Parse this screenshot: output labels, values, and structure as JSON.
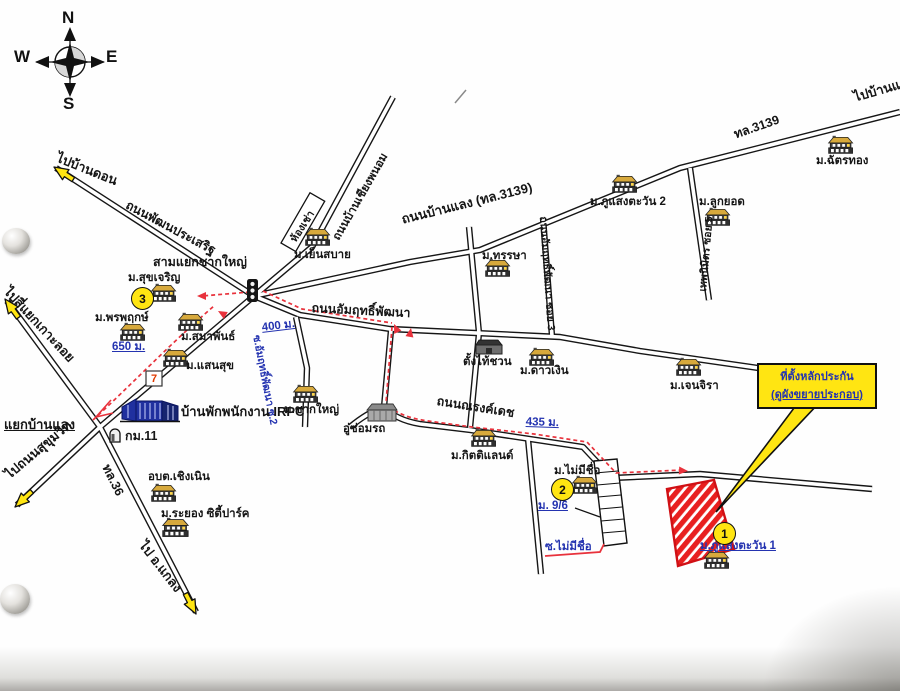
{
  "compass": {
    "n": "N",
    "w": "W",
    "e": "E",
    "s": "S"
  },
  "junctions": {
    "chak_yai": "สามแยกชากใหญ่",
    "ban_laeng": "แยกบ้านแลง"
  },
  "destinations": {
    "ban_don": "ไปบ้านดอน",
    "ko_loi": "ไปสี่แยกเกาะลอย",
    "sukhumvit": "ไปถนนสุขุมวิท",
    "klaeng": "ไป อ.แกลง",
    "ban_lae": "ไปบ้านแล"
  },
  "roads": {
    "phatthana_prasert": "ถนนพัฒนประเสริฐ",
    "ban_chiang_phanom": "ถนนบ้านเชียงพนอม",
    "ban_laeng_hwy": "ถนนบ้านแลง (ทล.3139)",
    "hwy_3139": "ทล.3139",
    "hwy_36": "ทล.36",
    "amrit_phatthana": "ถนนอัมฤทธิ์พัฒนา",
    "amrit_soi2": "ซ.อัมฤทธิ์พัฒนา ซ.2",
    "amrit_soi3": "ถนนอัมฤทธิ์พัฒนา ซอย 3",
    "thep_nimit_soi": "เทพนิมิตร ซอย 5",
    "narong_det": "ถนนณรงค์เดช",
    "soi_no_name": "ซ.ไม่มีชื่อ",
    "mu_9_6": "ม. 9/6"
  },
  "distances": {
    "d650": "650 ม.",
    "d400": "400 ม.",
    "d435": "435 ม."
  },
  "places": {
    "suk_charoen": "ม.สุขเจริญ",
    "phon_phruek": "ม.พรพฤกษ์",
    "samaphan": "ม.สมาพันธ์",
    "saen_suk": "ม.แสนสุข",
    "yen_sabai": "ม.เย็นสบาย",
    "hong_chao": "ห้องเช่า",
    "thansa": "ม.ทรรษา",
    "chak_yai_village": "ม.ชากใหญ่",
    "irpc_housing": "บ้านพักพนักงาน IRPC",
    "km11": "กม.11",
    "obt_choeng_noen": "อบต.เชิงเนิน",
    "rayong_city_park": "ม.ระยอง ซิตี้ปาร์ค",
    "tang_thai_chuan": "ตั้งไท้ชวน",
    "dao_ngoen": "ม.ดาวเงิน",
    "jenjira": "ม.เจนจิรา",
    "chat_thong": "ม.ฉัตรทอง",
    "phu_saeng_tawan2": "ม.ภูแสงตะวัน 2",
    "luk_yot": "ม.ลูกยอด",
    "kitti_land": "ม.กิตติแลนด์",
    "garage": "อู่ซ่อมรถ",
    "no_name_village": "ม.ไม่มีชื่อ",
    "phu_saeng_tawan1": "ม.ภูแสงตะวัน 1"
  },
  "markers": {
    "site": "1",
    "two": "2",
    "three": "3"
  },
  "callout": {
    "line1": "ที่ตั้งหลักประกัน",
    "line2": "(ดูผังขยายประกอบ)"
  },
  "seven_eleven": "7",
  "colors": {
    "highlight_yellow": "#ffe512",
    "site_red": "#e8201f",
    "route_red": "#e8323c",
    "label_blue": "#2433b0"
  }
}
